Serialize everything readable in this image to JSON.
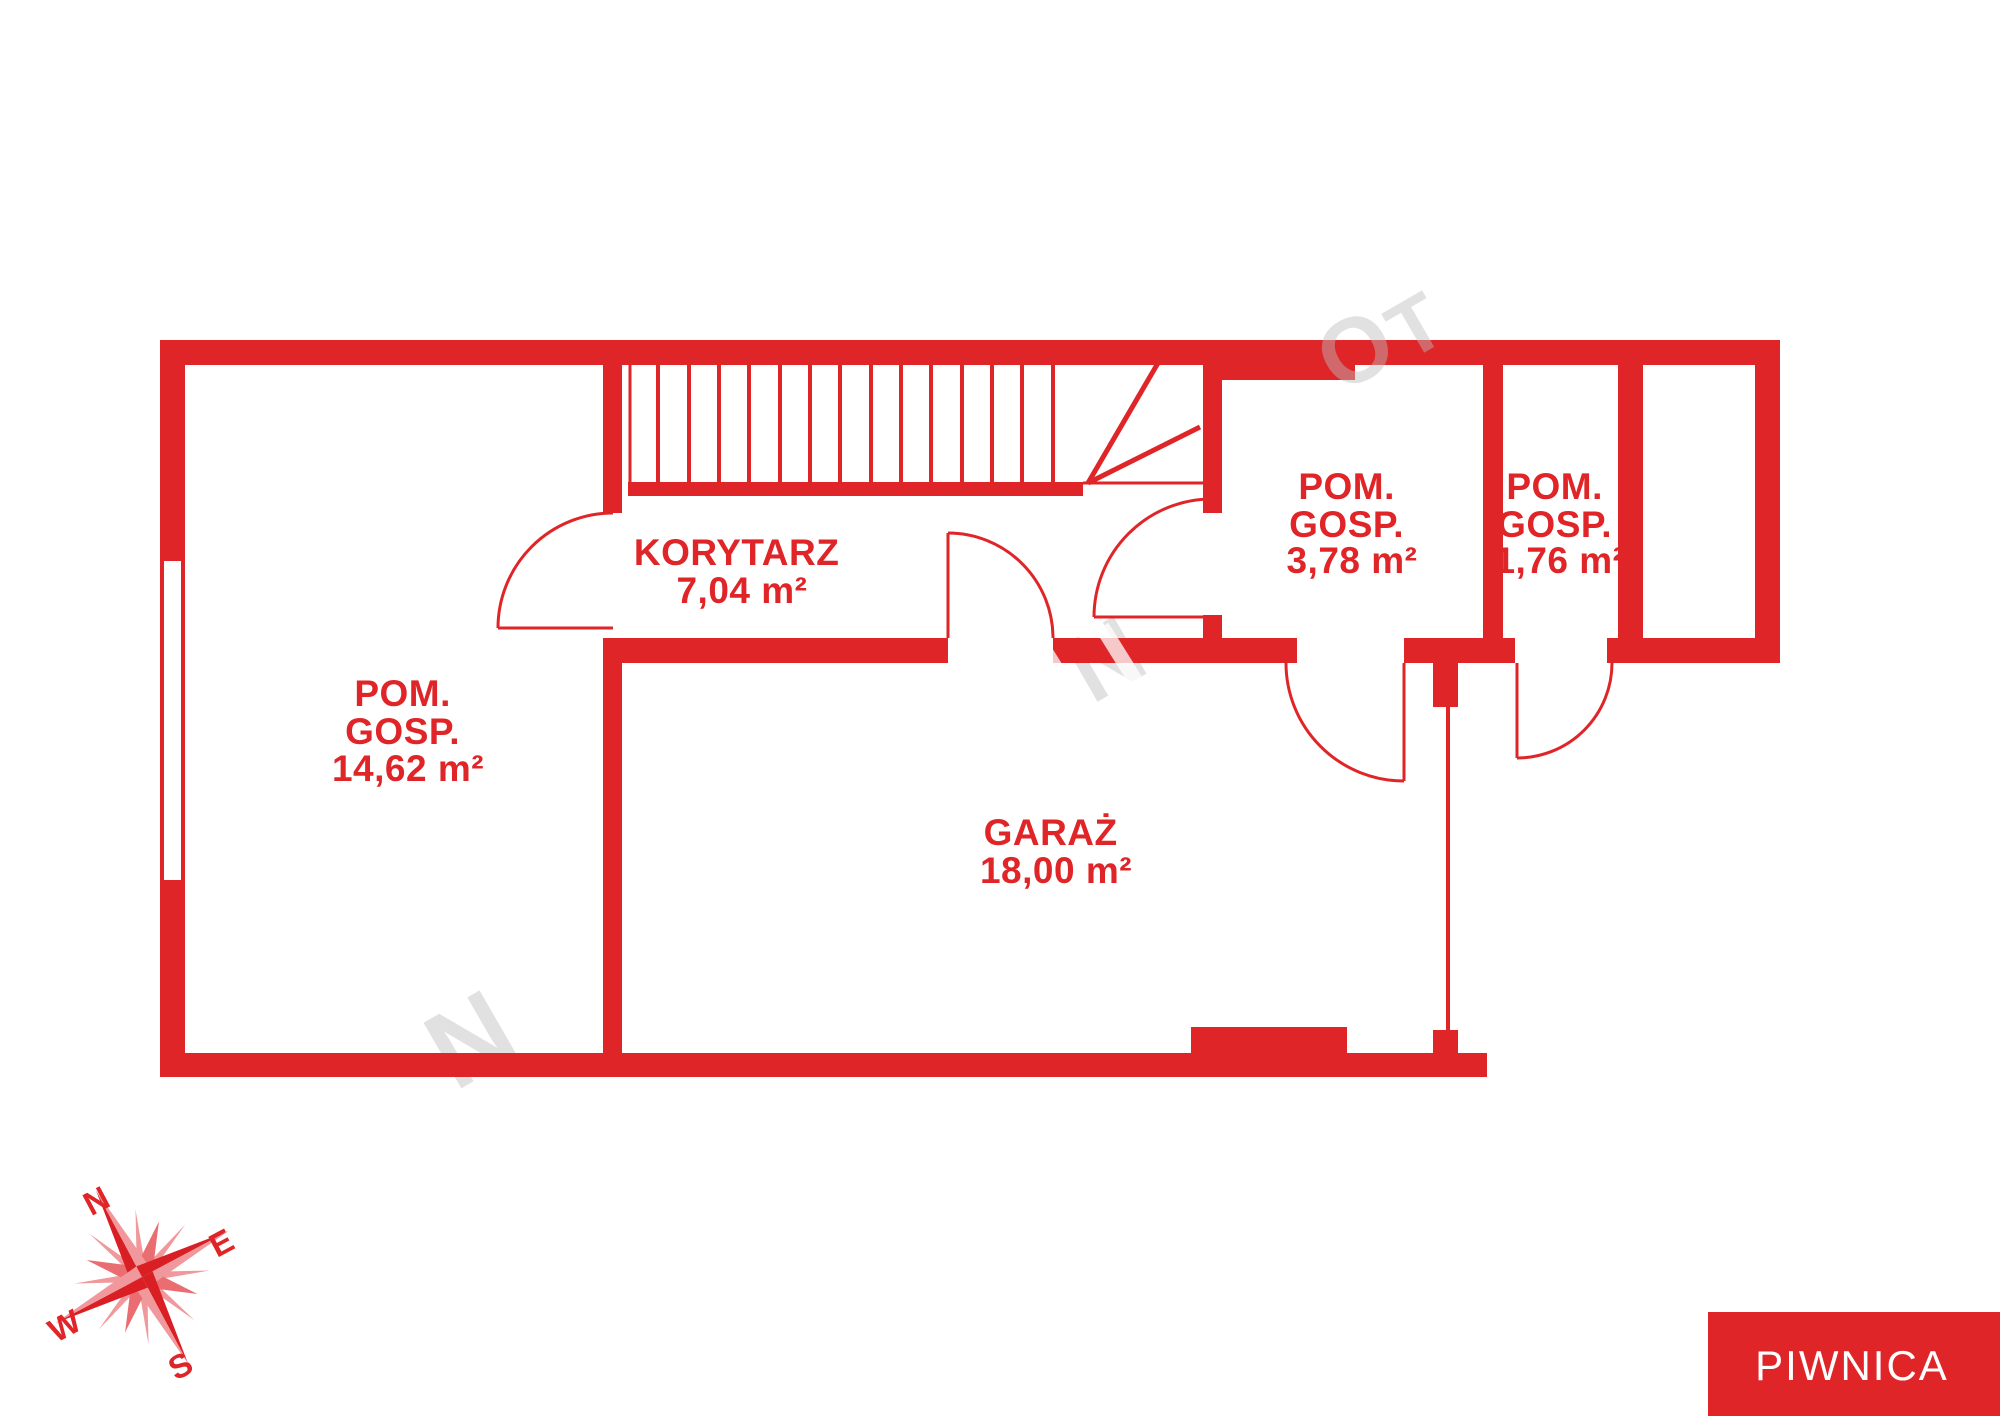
{
  "palette": {
    "wall-red": "#e02528",
    "light-red": "#f0989b",
    "mid-red": "#ea6d71",
    "wm-gray": "#bdbdbd"
  },
  "floor_badge": {
    "label": "PIWNICA"
  },
  "rooms": [
    {
      "id": "pom-gosp-large",
      "lines": [
        "POM.",
        "GOSP.",
        "14,62 m²"
      ]
    },
    {
      "id": "korytarz",
      "lines": [
        "KORYTARZ",
        "7,04 m²"
      ]
    },
    {
      "id": "garaz",
      "lines": [
        "GARAŻ",
        "18,00 m²"
      ]
    },
    {
      "id": "pom-gosp-medium",
      "lines": [
        "POM.",
        "GOSP.",
        "3,78 m²"
      ]
    },
    {
      "id": "pom-gosp-small",
      "lines": [
        "POM.",
        "GOSP.",
        "1,76 m²"
      ]
    }
  ],
  "compass": {
    "north": "N",
    "east": "E",
    "south": "S",
    "west": "W"
  },
  "watermark": {
    "fragments": [
      "O",
      "T",
      "N",
      "N"
    ]
  }
}
